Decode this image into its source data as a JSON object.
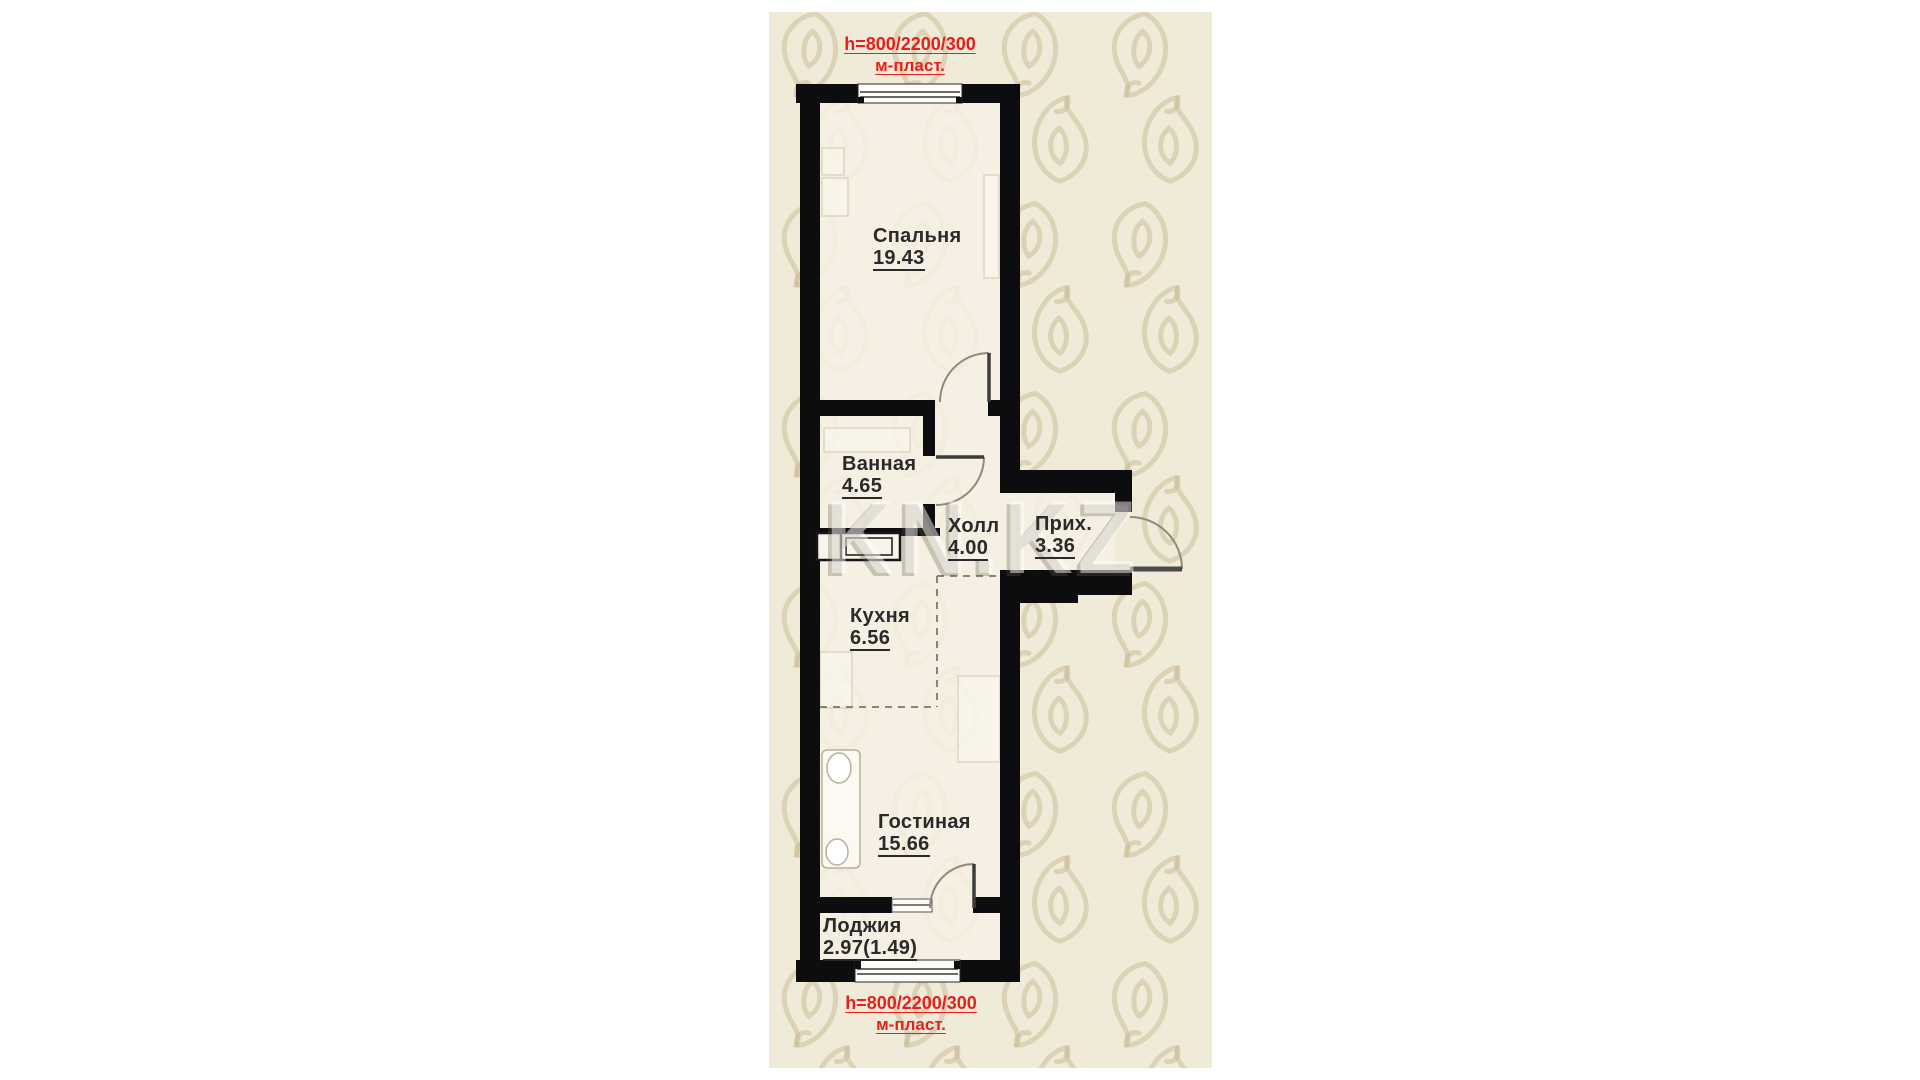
{
  "plan": {
    "rooms": [
      {
        "id": "bedroom",
        "name": "Спальня",
        "area": "19.43"
      },
      {
        "id": "bathroom",
        "name": "Ванная",
        "area": "4.65"
      },
      {
        "id": "hall",
        "name": "Холл",
        "area": "4.00"
      },
      {
        "id": "entry",
        "name": "Прих.",
        "area": "3.36"
      },
      {
        "id": "kitchen",
        "name": "Кухня",
        "area": "6.56"
      },
      {
        "id": "living",
        "name": "Гостиная",
        "area": "15.66"
      },
      {
        "id": "loggia",
        "name": "Лоджия",
        "area": "2.97(1.49)"
      }
    ],
    "annotations": {
      "top": {
        "line1": "h=800/2200/300",
        "line2": "м-пласт."
      },
      "bottom": {
        "line1": "h=800/2200/300",
        "line2": "м-пласт."
      }
    },
    "watermark": {
      "text": "KN.KZ"
    },
    "colors": {
      "page_background": "#ffffff",
      "panel_background": "#f0ead9",
      "floor": "#f6f1e4",
      "wall": "#0d0d10",
      "annotation_red": "#e8201c",
      "label_text": "#2a2a2a"
    }
  }
}
